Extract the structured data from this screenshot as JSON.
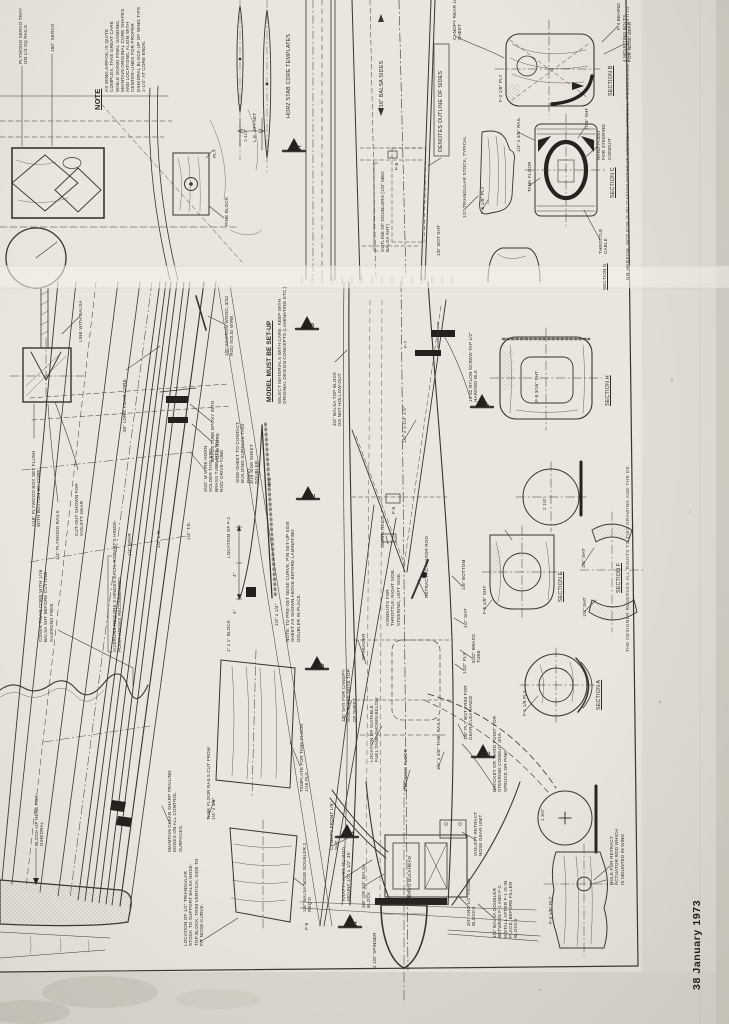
{
  "page": {
    "footer": "38 January 1973",
    "rights_upper": "GN HEREON. NOT FOR DUPLICATION WITHOUT WRITTEN APPROVAL. POSSESSION DOES NOT CONSTITU",
    "rights_lower": "THE DESIGNER RESERVES ALL RIGHTS TO THIS DRAWING AND THE DE"
  },
  "colors": {
    "paper": "#e9e6df",
    "margin_paper": "#e0ddd5",
    "fold": "#f2f0e9",
    "ink": "#38342e"
  },
  "labels": {
    "servo_tray": "PLYWOOD SERVO TRAY ON 1/4 SQ RAILS",
    "servo_180": "180° SERVO",
    "note_h": "NOTE",
    "note_b": "AS WING AIRFOIL IS QUITE COMPLEX, TAKE GREAT CARE WHILE DOING FINAL SANDING. MAINTAIN ORIGINAL CORE SHAPES AND LOCATIONS. ALIGN WITH CENTER-LINES FOR PROPER DIHEDRAL BLOCK-UP OF WING TIPS 1-1/4\" AT CORE ENDS.",
    "horz_stab": "HORZ STAB CORE TEMPLATES",
    "le_offset": "L.E. OFFSET",
    "dim_1half": "1-1/2\"",
    "balsa_sides": "3/16\" BALSA SIDES",
    "denotes": "DENOTES OUTLINE OF SIDES",
    "doublers": "OUTLINE OF DOUBLERS (1/8\" MED BALSA SHT)",
    "f8a": "F-8",
    "bot_sht": "1/8\" BOT SHT",
    "canopy_rear": "CANOPY REAR 1/2\" SHEET",
    "sec_b": "SECTION B",
    "f2_ply": "F-2 1/8\" PLY",
    "f4_behind": "F-4 BEHIND",
    "mounting": "4 MOUNTING BOLTS FOR NOSE GEAR",
    "tri_stock": "1/2\" TRIANGULAR STOCK, TYPICAL",
    "f6_ply": "F-6 1/8\" PLY",
    "tank_floor": "TANK FLOOR",
    "rail_qtr": "1/4\" x 3/8\" RAIL",
    "sht116": "1/16\" SHT",
    "hard_point": "HARD POINT FOR STEERING CONDUIT",
    "sec_c": "SECTION C",
    "throttle": "THROTTLE CABLE",
    "sec_g": "SECTION G",
    "pine_block": "PINE BLOCK",
    "ply": "PLY",
    "model_h": "MODEL MUST BE SET-UP",
    "model_b": "SELECT MATERIALS WITH CARE. KEEP WITH ORIGINAL DESIGN CONCEPTS (LAMINATING ETC.)",
    "foam30": "30\" LONG FOAM CORE",
    "brass_epoxy": "BRASS TUBE EPOXY INTO FOAM CORE",
    "ail_wire": "1/8\" AILERON WOOD, 3/32 ROD SOLID WIRE",
    "line_balsa": "LINE WITH BALSA",
    "plybox": "1/16\" PLYWOOD BOX SET FLUSH WITH BOTTOM OF CORE",
    "plyrails": "1/4\" PLYWOOD RAILS",
    "cutout": "CUT-OUT SHOWN FOR VIOLETT GEAR",
    "horn": "3/32\" M WIRE HORN SOLDER THIS END. BRASS TUBE FITS 'NU-ROD' DRIVE-TUBE",
    "topblock": "3/4\" BALSA TOP BLOCK DO NOT HOLLOW-OUT",
    "contact": "SIDE-SHEET TO CONTACT BUILDING SURFACE THIS POINT",
    "sdoubler": "3/16 SIDE SHEET DOUBLER",
    "nts": "NTS",
    "loc_f2": "LOCATION OF F-2",
    "dim4a": "4\"",
    "dim4b": "4\"",
    "blk1x1": "1\" x 1\" BLOCK",
    "qtr_sq": "1/4\" x 1/4\"",
    "preset": "NOTE: TO PRE-SET NOSE CURVE, PIN SET-UP SIDE SHEET AS SHOWN ABOVE BEFORE LAMINATING DOUBLER IN PLACE.",
    "spar": "1/4\" SPAR",
    "le14": "1/4\" L.E.",
    "te14": "1/4\" T.E.",
    "cover": "COVER FOAM CORE WITH 1/16 BALSA SHT BEFORE CUTTING AILERONS FREE",
    "hinges": "AILERONS REQUIRE 4 HINGES EACH. ROBART'S HINGE-POINT HINGES RECOMMENDED",
    "servo_rails": "SERVO RAILS",
    "f5": "F-5",
    "f7": "F-7",
    "conduits": "CONDUITS FOR THROTTLE, RIGHT SIDE. STEERING, LEFT SIDE.",
    "retract_rod": "RETRACT ACTUATOR ROD",
    "bot18": "1/8\" BOTTOM",
    "sht12": "1/2\" SHT",
    "sht316": "3/16\" SHT",
    "nylon": "10-32 NYLON SCREW TAP 1/2\" HARDWD BLK",
    "hwdim": "1/2\" x 1-1/4\" x 5\"",
    "sec_h": "SECTION H",
    "f8_sht": "F-8 3/16\" SHT",
    "d214": "2 1/4\"",
    "sec_e": "SECTION E",
    "f5_sht": "F-5 1/8\" SHT",
    "sec_f": "SECTION F",
    "fsht18": "1/8\" SHT",
    "fsht12": "1/2\" SHT",
    "sec_a": "SECTION A",
    "f1_ply": "F-1 1/8 PLY",
    "d134": "1 3/4\"",
    "bracket": "BRACKET OR 'HARD POINT' FOR STEERING CONDUIT 3/16 SPRUCE OR PINE",
    "bottrim": "1/8\" PLY BOT TRIM FOR GEAR CLEARANCE",
    "ply132": "1/32\" PLY",
    "brass532": "5/32\" BRASS TUBE",
    "tankrails": "1/4\" x 3/8\" TANK RAILS",
    "tfloor116": "1/16\" TANK FLOOR",
    "tankloc": "LOCATION OF SUITABLE FUEL TANK SHOWN BELOW",
    "spreader": "SPREADER",
    "canopysides": "1/8\" SHT FOR CANOPY SIDES. SEE NOTE TOP OF SHEET",
    "template": "TEMPLATE FOR TANK FLOOR 1/16 PLY",
    "tfrails": "TANK FLOOR RAILS CUT FROM 1/4\" x 3/8\"",
    "maintain": "MAINTAIN CLEAN SHARP TRAILING EDGES ON ALL CONTROL SURFACES.",
    "blockup": "BLOCK-UP HERE FOR DIHEDRAL",
    "ndoubler": "1/8\" BALSA NOSE DOUBLER 2 REQ'D",
    "tri_loc": "LOCATION OF 1/2\" TRIANGULAR STOCK TO SUPPORT BALSA NOSE-TOP BLOCK. TRIM VERTICAL SIDE TO FIT NOSE-CURVE.",
    "canopyfront": "CANOPY FRONT 1/8\" SHT",
    "kraft": "KRAFT-HAYES NU-ROD MOUNT 1/2\" x 1/2\" 45°",
    "nblock": "3/8\" OR 3/4\" BALSA BLOCK",
    "sbulkhead": "SERVO BULKHEAD",
    "spinner": "2 1/8\" SPINNER",
    "violett": "VIOLETT RETRACT NOSE GEAR UNIT",
    "bdoubler": "1/8\" BALSA DOUBLER BETWEEN F-1 AND F-2. INSTALL AFTER F-1 IS IN PLACE, BEFORE FILLER BLOCKS",
    "filler": "3/4\" AND 1/2\" FILLER BLOCKS",
    "f4_ply": "F-4 1/8\" PLY",
    "hole": "HOLE FOR RETRACT ACTUATOR ROD WHICH IS MOUNTED IN WING",
    "f8b": "F-8",
    "arr_h": "H",
    "arr_g": "G",
    "arr_e": "E",
    "arr_d": "D",
    "arr_f": "F",
    "arr_c": "C",
    "arr_a": "A",
    "arr_b": "B"
  }
}
